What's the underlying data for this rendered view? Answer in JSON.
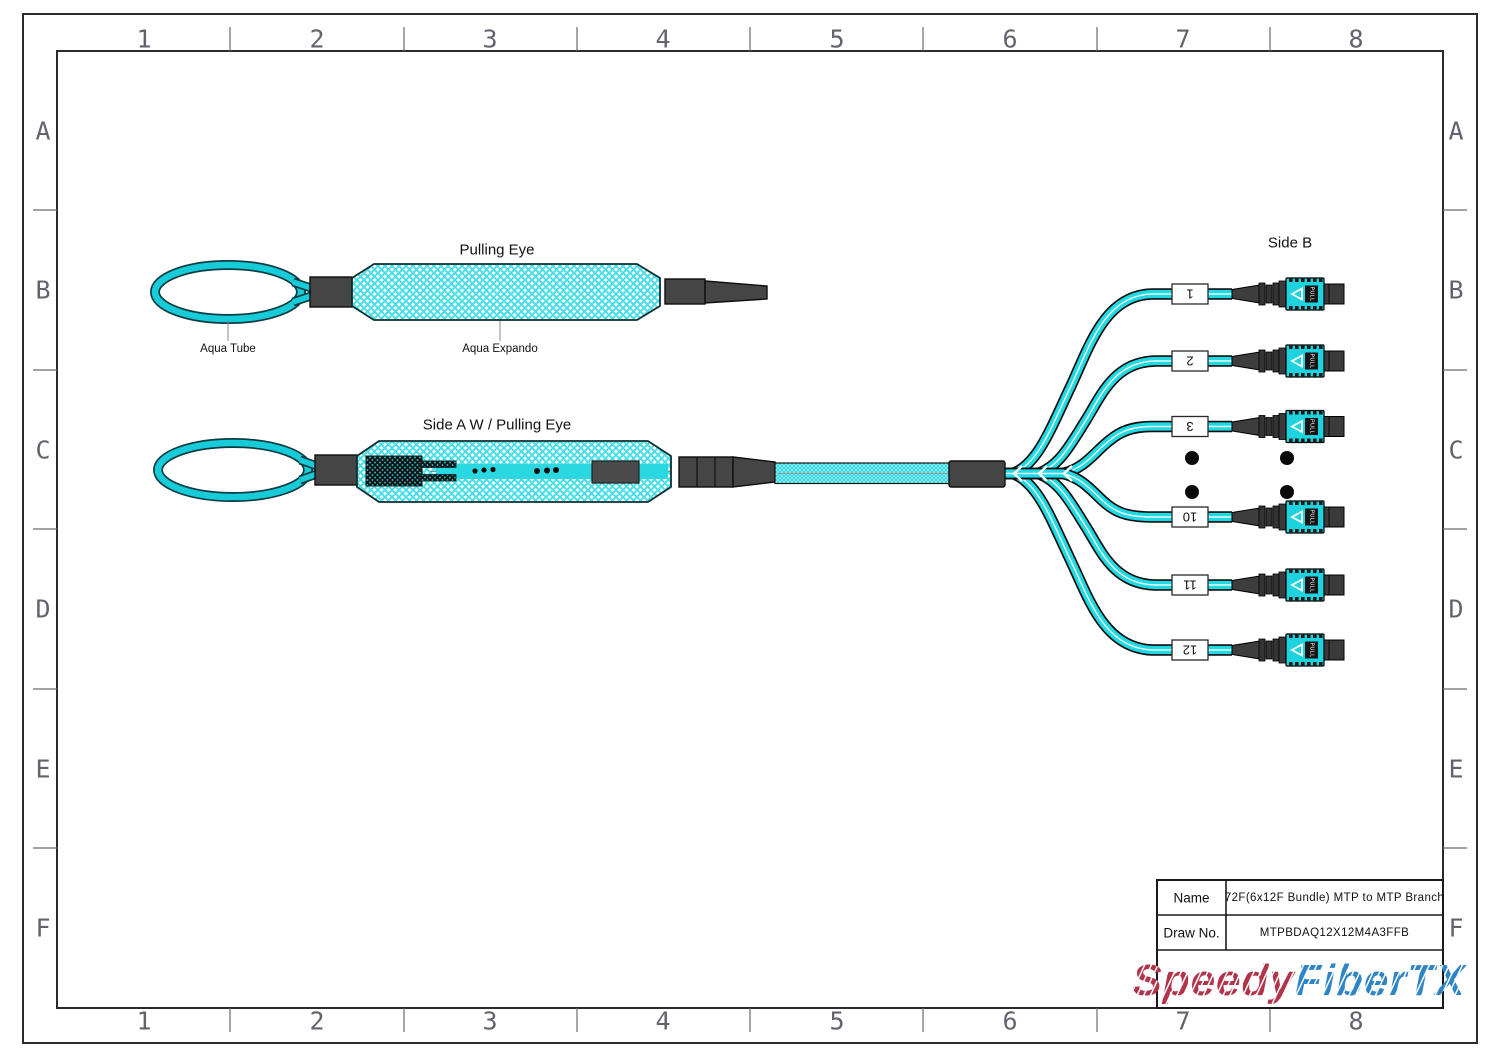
{
  "drawing": {
    "grid": {
      "columns": [
        "1",
        "2",
        "3",
        "4",
        "5",
        "6",
        "7",
        "8"
      ],
      "rows": [
        "A",
        "B",
        "C",
        "D",
        "E",
        "F"
      ]
    },
    "pulling_eye": {
      "title": "Pulling Eye",
      "aqua_tube_label": "Aqua Tube",
      "aqua_expando_label": "Aqua Expando"
    },
    "side_a": {
      "title": "Side A W / Pulling Eye"
    },
    "side_b": {
      "title": "Side B",
      "branch_labels": [
        "1",
        "2",
        "3",
        "10",
        "11",
        "12"
      ],
      "connector_pull_text": "PULL"
    },
    "title_block": {
      "name_label": "Name",
      "name_value": "72F(6x12F Bundle) MTP to MTP Branch",
      "draw_label": "Draw No.",
      "draw_value": "MTPBDAQ12X12M4A3FFB",
      "logo_part1": "Speedy",
      "logo_part2": "FiberTX"
    },
    "colors": {
      "aqua": "#1fd9e3",
      "dark_gray": "#454545",
      "logo_red": "#b2334a",
      "logo_blue": "#2d84c6"
    }
  }
}
